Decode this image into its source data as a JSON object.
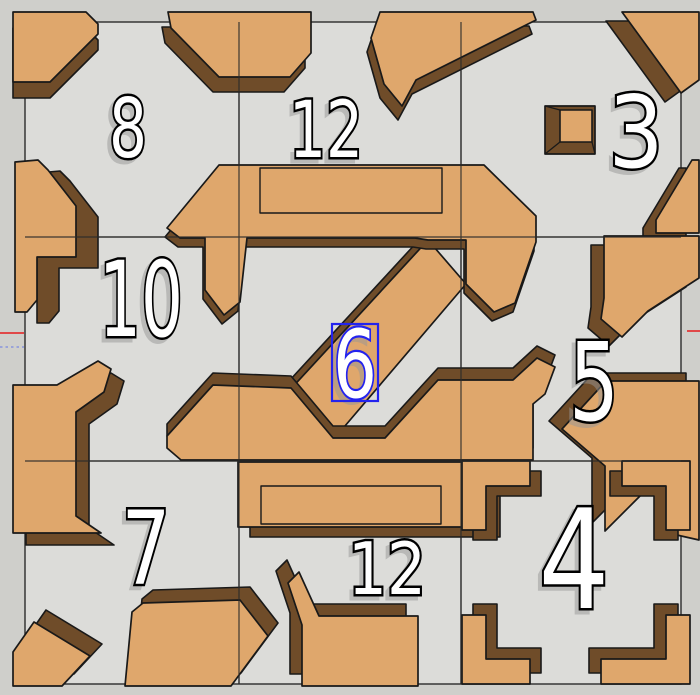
{
  "app": {
    "name": "3d-model-viewport",
    "description": "3D puzzle wall model with numbered cells, one 3D text label selected"
  },
  "colors": {
    "outer_background": "#cfcfcb",
    "board_background": "#dcdcd9",
    "block_top": "#dfa76c",
    "block_side": "#6f4c29",
    "edge_stroke": "#191919",
    "grid_stroke": "#2b2b2b",
    "number_fill": "#ffffff",
    "number_outline": "#000000",
    "number_shadow": "#979797",
    "selection_blue": "#2323ee",
    "axis_red": "#e04848",
    "axis_dotted": "#9aa3d8"
  },
  "board": {
    "x": 25,
    "y": 22,
    "width": 656,
    "height": 662
  },
  "grid": {
    "vertical_x": [
      239,
      461
    ],
    "horizontal_y": [
      237,
      461
    ]
  },
  "axes": [
    {
      "name": "axis-red-left",
      "x1": 0,
      "y1": 333,
      "x2": 24,
      "y2": 333,
      "color": "axis_red",
      "dotted": false
    },
    {
      "name": "axis-red-right",
      "x1": 687,
      "y1": 331,
      "x2": 700,
      "y2": 331,
      "color": "axis_red",
      "dotted": false
    },
    {
      "name": "axis-dotted-left",
      "x1": 0,
      "y1": 347,
      "x2": 24,
      "y2": 347,
      "color": "axis_dotted",
      "dotted": true
    }
  ],
  "pieces": [
    {
      "id": "a1-top-left-corner",
      "face": "M13,12 L86,12 L98,24 L98,34 L50,82 L13,82 Z",
      "dx": 0,
      "dy": 16
    },
    {
      "id": "a2-top-bar-left",
      "face": "M168,12 L311,12 L311,53 L290,77 L219,77 L171,28 Z",
      "dx": -6,
      "dy": 15
    },
    {
      "id": "a3-top-bar-spike",
      "face": "M380,12 L533,12 L536,20 L416,80 L402,106 L384,84 L371,38 Z",
      "dx": -4,
      "dy": 14
    },
    {
      "id": "a4-top-right-corner",
      "face": "M622,12 L699,12 L699,80 L681,93 Z",
      "dx": -16,
      "dy": 9
    },
    {
      "id": "b1-left-wall-step",
      "face": "M15,162 L38,160 L48,170 L76,206 L76,257 L37,257 L37,300 L27,312 L15,312 Z",
      "dx": 22,
      "dy": 11
    },
    {
      "id": "b2-left-wall-arm",
      "face": "M13,385 L57,385 L98,361 L111,369 L104,392 L76,412 L76,516 L101,533 L13,533 Z",
      "dx": 13,
      "dy": 12
    },
    {
      "id": "b3-right-wall-upper",
      "face": "M692,160 L699,160 L699,233 L656,233 L656,220 Z",
      "dx": -13,
      "dy": 8
    },
    {
      "id": "c1-right-wall-spike",
      "face": "M604,236 L699,236 L699,278 L648,311 L622,337 L601,319 L604,298 Z",
      "dx": -13,
      "dy": 9
    },
    {
      "id": "c2-right-wall-lower",
      "face": "M606,381 L699,381 L699,540 L668,533 L668,497 L646,490 L605,531 L605,466 L562,429 Z",
      "dx": -13,
      "dy": -8
    },
    {
      "id": "s2-center-diagonal",
      "face": "M428,240 L466,284 L333,440 L288,392 Z",
      "dx": -10,
      "dy": 1
    },
    {
      "id": "s1-center-top-bar",
      "face": "M219,165 L484,165 L536,216 L536,242 L515,303 L494,312 L466,284 L466,240 L428,240 L415,238 L247,238 L240,302 L224,315 L205,290 L205,238 L180,238 L167,228 Z",
      "dx": -2,
      "dy": 9
    },
    {
      "id": "s3-center-bottom-bar",
      "face": "M213,385 L291,388 L333,438 L385,438 L438,380 L513,380 L537,358 L555,367 L545,394 L533,404 L533,460 L181,460 L167,448 L167,436 Z",
      "dx": 0,
      "dy": -12
    },
    {
      "id": "d2a-bottom-mid-slab",
      "face": "M238,462 L488,462 L488,527 L238,527 Z",
      "dx": 12,
      "dy": 10
    },
    {
      "id": "d1-bottom-left-corner",
      "face": "M13,652 L34,622 L90,656 L62,686 L13,686 Z",
      "dx": 12,
      "dy": -12
    },
    {
      "id": "d2-bottom-block-left",
      "face": "M132,612 L143,603 L240,600 L268,636 L231,686 L125,686 Z",
      "dx": 10,
      "dy": -13
    },
    {
      "id": "d3-bottom-block-right",
      "face": "M302,686 L302,625 L288,583 L299,572 L319,616 L418,616 L418,686 Z",
      "dx": -12,
      "dy": -12
    },
    {
      "id": "e1-L-corner-nw",
      "face": "M462,461 L530,461 L530,486 L486,486 L486,530 L462,530 Z",
      "dx": 11,
      "dy": 10
    },
    {
      "id": "e2-L-corner-ne",
      "face": "M622,461 L690,461 L690,530 L666,530 L666,486 L622,486 Z",
      "dx": -12,
      "dy": 10
    },
    {
      "id": "e3-L-corner-sw",
      "face": "M462,615 L486,615 L486,659 L530,659 L530,684 L462,684 Z",
      "dx": 11,
      "dy": -11
    },
    {
      "id": "e4-L-corner-se",
      "face": "M666,615 L690,615 L690,684 L601,684 L601,659 L666,659 Z",
      "dx": -12,
      "dy": -11
    }
  ],
  "cube": {
    "id": "a5-small-cube",
    "outer": {
      "x": 545,
      "y": 106,
      "width": 50,
      "height": 48
    },
    "top": {
      "x": 560,
      "y": 110,
      "width": 32,
      "height": 32
    }
  },
  "inner_edges": [
    {
      "id": "top-bar-inner-loop",
      "x": 260,
      "y": 168,
      "width": 182,
      "height": 45
    },
    {
      "id": "bottom-slab-inner-loop",
      "x": 261,
      "y": 486,
      "width": 180,
      "height": 38
    }
  ],
  "numbers": [
    {
      "label": "8",
      "x": 128,
      "baseline": 157,
      "size": 82,
      "width": 38,
      "selected": false
    },
    {
      "label": "12",
      "x": 326,
      "baseline": 157,
      "size": 78,
      "width": 74,
      "selected": false
    },
    {
      "label": "3",
      "x": 636,
      "baseline": 167,
      "size": 100,
      "width": 55,
      "selected": false
    },
    {
      "label": "10",
      "x": 141,
      "baseline": 336,
      "size": 104,
      "width": 84,
      "selected": false
    },
    {
      "label": "6",
      "x": 355,
      "baseline": 397,
      "size": 94,
      "width": 44,
      "selected": true
    },
    {
      "label": "5",
      "x": 594,
      "baseline": 420,
      "size": 108,
      "width": 50,
      "selected": false
    },
    {
      "label": "7",
      "x": 146,
      "baseline": 584,
      "size": 102,
      "width": 49,
      "selected": false
    },
    {
      "label": "12",
      "x": 387,
      "baseline": 594,
      "size": 72,
      "width": 78,
      "selected": false
    },
    {
      "label": "4",
      "x": 574,
      "baseline": 608,
      "size": 138,
      "width": 71,
      "selected": false
    }
  ],
  "selection_box": {
    "x": 332,
    "y": 324,
    "width": 46,
    "height": 77
  }
}
